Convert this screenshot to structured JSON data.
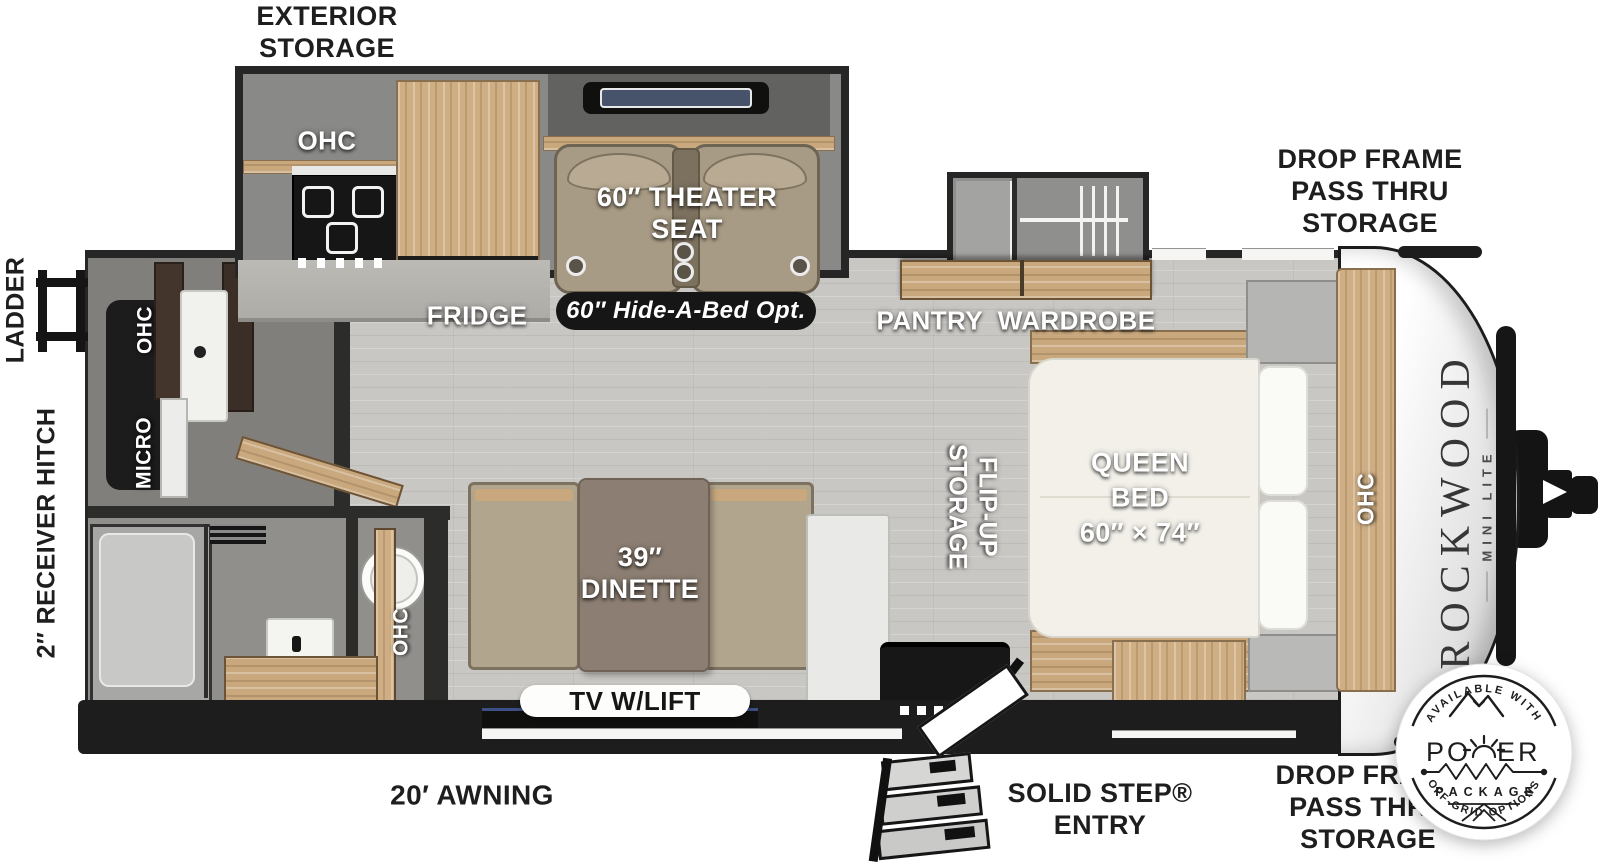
{
  "plan": {
    "exterior_storage": "EXTERIOR\nSTORAGE",
    "drop_frame_top": "DROP FRAME\nPASS THRU\nSTORAGE",
    "drop_frame_bottom": "DROP FRAME\nPASS THRU\nSTORAGE",
    "ladder": "LADDER",
    "receiver_hitch": "2″ RECEIVER HITCH",
    "awning": "20′ AWNING",
    "solid_step": "SOLID STEP®\nENTRY",
    "ohc_slide": "OHC",
    "ohc_rear": "OHC",
    "ohc_bath": "OHC",
    "ohc_bed": "OHC",
    "micro": "MICRO",
    "fridge": "FRIDGE",
    "pantry_wardrobe": "PANTRY  WARDROBE",
    "theater_seat": "60″ THEATER\nSEAT",
    "hide_a_bed": "60″ Hide-A-Bed Opt.",
    "queen_bed": "QUEEN\nBED\n60″ × 74″",
    "flip_up_storage": "FLIP-UP\nSTORAGE",
    "dinette": "39″\nDINETTE",
    "tv_w_lift": "TV W/LIFT"
  },
  "branding": {
    "model": "ROCKWOOD",
    "series": "MINI LITE",
    "badge_top": "AVAILABLE WITH",
    "badge_power_left": "PO",
    "badge_power_right": "ER",
    "badge_package": "PACKAGE",
    "badge_bottom": "OFF-GRID OPTIONS"
  },
  "icons": {
    "ladder": "ladder-icon",
    "entry_steps": "folding-steps-icon",
    "badge_mountains": "mountains-icon",
    "badge_sun": "sunrise-icon",
    "badge_resistor": "zigzag-line-icon",
    "badge_solar": "solar-panel-icon"
  },
  "colors": {
    "wall": "#262626",
    "floor": "#c9c7c3",
    "wood_light": "#cfae84",
    "slide_gray": "#898987",
    "seat_tan": "#a89b85",
    "table_brown": "#8c7e72",
    "mattress": "#f2f0e9",
    "label_light": "#ffffff",
    "label_dark": "#1e1e1e"
  }
}
